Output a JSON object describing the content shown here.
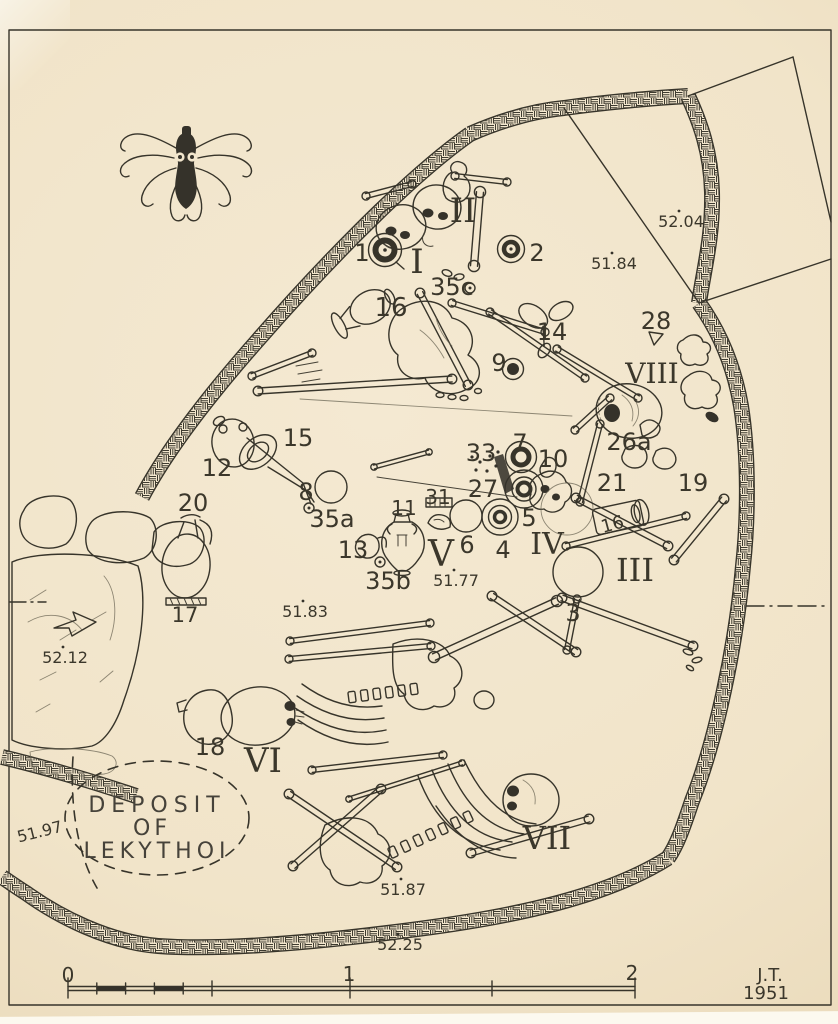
{
  "colors": {
    "paper": "#f2e6cd",
    "ink": "#37342a"
  },
  "plan": {
    "deposit_label": {
      "line1": "DEPOSIT",
      "line2": "OF",
      "line3": "LEKYTHOI"
    },
    "signature": {
      "initials": "J.T.",
      "year": "1951"
    },
    "scale_bar": {
      "tick_labels": [
        "0",
        "1",
        "2"
      ]
    },
    "labels": [
      {
        "kind": "artifact",
        "text": "1",
        "x": 362,
        "y": 261
      },
      {
        "kind": "artifact",
        "text": "2",
        "x": 537,
        "y": 261
      },
      {
        "kind": "artifact",
        "text": "3",
        "x": 573,
        "y": 621
      },
      {
        "kind": "artifact",
        "text": "4",
        "x": 503,
        "y": 558
      },
      {
        "kind": "artifact",
        "text": "5",
        "x": 529,
        "y": 526
      },
      {
        "kind": "artifact",
        "text": "6",
        "x": 467,
        "y": 553
      },
      {
        "kind": "artifact",
        "text": "7",
        "x": 520,
        "y": 451
      },
      {
        "kind": "artifact",
        "text": "8",
        "x": 306,
        "y": 500
      },
      {
        "kind": "artifact",
        "text": "9",
        "x": 499,
        "y": 371
      },
      {
        "kind": "artifact",
        "text": "10",
        "x": 553,
        "y": 467
      },
      {
        "kind": "artifact",
        "text": "11",
        "x": 404,
        "y": 515,
        "size": 20
      },
      {
        "kind": "artifact",
        "text": "12",
        "x": 217,
        "y": 476
      },
      {
        "kind": "artifact",
        "text": "13",
        "x": 353,
        "y": 558
      },
      {
        "kind": "artifact",
        "text": "14",
        "x": 552,
        "y": 340
      },
      {
        "kind": "artifact",
        "text": "15",
        "x": 298,
        "y": 446
      },
      {
        "kind": "artifact",
        "text": "16",
        "x": 391,
        "y": 316,
        "size": 26
      },
      {
        "kind": "artifact",
        "text": "16",
        "x": 614,
        "y": 530,
        "size": 18,
        "rotate": -15
      },
      {
        "kind": "artifact",
        "text": "17",
        "x": 185,
        "y": 622,
        "size": 21
      },
      {
        "kind": "artifact",
        "text": "18",
        "x": 210,
        "y": 755
      },
      {
        "kind": "artifact",
        "text": "19",
        "x": 693,
        "y": 491
      },
      {
        "kind": "artifact",
        "text": "20",
        "x": 193,
        "y": 511
      },
      {
        "kind": "artifact",
        "text": "21",
        "x": 612,
        "y": 491
      },
      {
        "kind": "artifact",
        "text": "26a",
        "x": 629,
        "y": 450
      },
      {
        "kind": "artifact",
        "text": "27",
        "x": 483,
        "y": 497
      },
      {
        "kind": "artifact",
        "text": "28",
        "x": 656,
        "y": 329
      },
      {
        "kind": "artifact",
        "text": "31",
        "x": 438,
        "y": 504,
        "size": 20
      },
      {
        "kind": "artifact",
        "text": "33",
        "x": 481,
        "y": 461
      },
      {
        "kind": "artifact",
        "text": "35a",
        "x": 332,
        "y": 527
      },
      {
        "kind": "artifact",
        "text": "35b",
        "x": 388,
        "y": 589
      },
      {
        "kind": "artifact",
        "text": "35c",
        "x": 452,
        "y": 295
      },
      {
        "kind": "grave",
        "text": "I",
        "x": 417,
        "y": 273,
        "size": 34
      },
      {
        "kind": "grave",
        "text": "II",
        "x": 463,
        "y": 222,
        "size": 34
      },
      {
        "kind": "grave",
        "text": "III",
        "x": 635,
        "y": 581,
        "size": 32
      },
      {
        "kind": "grave",
        "text": "IV",
        "x": 547,
        "y": 554,
        "size": 30
      },
      {
        "kind": "grave",
        "text": "V",
        "x": 441,
        "y": 566,
        "size": 36
      },
      {
        "kind": "grave",
        "text": "VI",
        "x": 263,
        "y": 772,
        "size": 34
      },
      {
        "kind": "grave",
        "text": "VII",
        "x": 547,
        "y": 849,
        "size": 32
      },
      {
        "kind": "grave",
        "text": "VIII",
        "x": 652,
        "y": 383,
        "size": 28
      },
      {
        "kind": "elevation",
        "text": "51.77",
        "x": 456,
        "y": 586
      },
      {
        "kind": "elevation",
        "text": "51.83",
        "x": 305,
        "y": 617
      },
      {
        "kind": "elevation",
        "text": "51.84",
        "x": 614,
        "y": 269
      },
      {
        "kind": "elevation",
        "text": "51.87",
        "x": 403,
        "y": 895
      },
      {
        "kind": "elevation",
        "text": "51.97",
        "x": 41,
        "y": 837,
        "rotate": -14
      },
      {
        "kind": "elevation",
        "text": "52.04",
        "x": 681,
        "y": 227
      },
      {
        "kind": "elevation",
        "text": "52.12",
        "x": 65,
        "y": 663
      },
      {
        "kind": "elevation",
        "text": "52.25",
        "x": 400,
        "y": 950
      },
      {
        "kind": "deposit",
        "text": "DEPOSIT",
        "x": 157,
        "y": 812,
        "spacing": 6
      },
      {
        "kind": "deposit",
        "text": "OF",
        "x": 152,
        "y": 835,
        "spacing": 4
      },
      {
        "kind": "deposit",
        "text": "LEKYTHOI",
        "x": 157,
        "y": 858,
        "spacing": 5
      },
      {
        "kind": "scale",
        "text": "0",
        "x": 68,
        "y": 982
      },
      {
        "kind": "scale",
        "text": "1",
        "x": 349,
        "y": 981
      },
      {
        "kind": "scale",
        "text": "2",
        "x": 632,
        "y": 980
      },
      {
        "kind": "signature",
        "text": "J.T.",
        "x": 770,
        "y": 981
      },
      {
        "kind": "signature",
        "text": "1951",
        "x": 766,
        "y": 999
      }
    ]
  }
}
